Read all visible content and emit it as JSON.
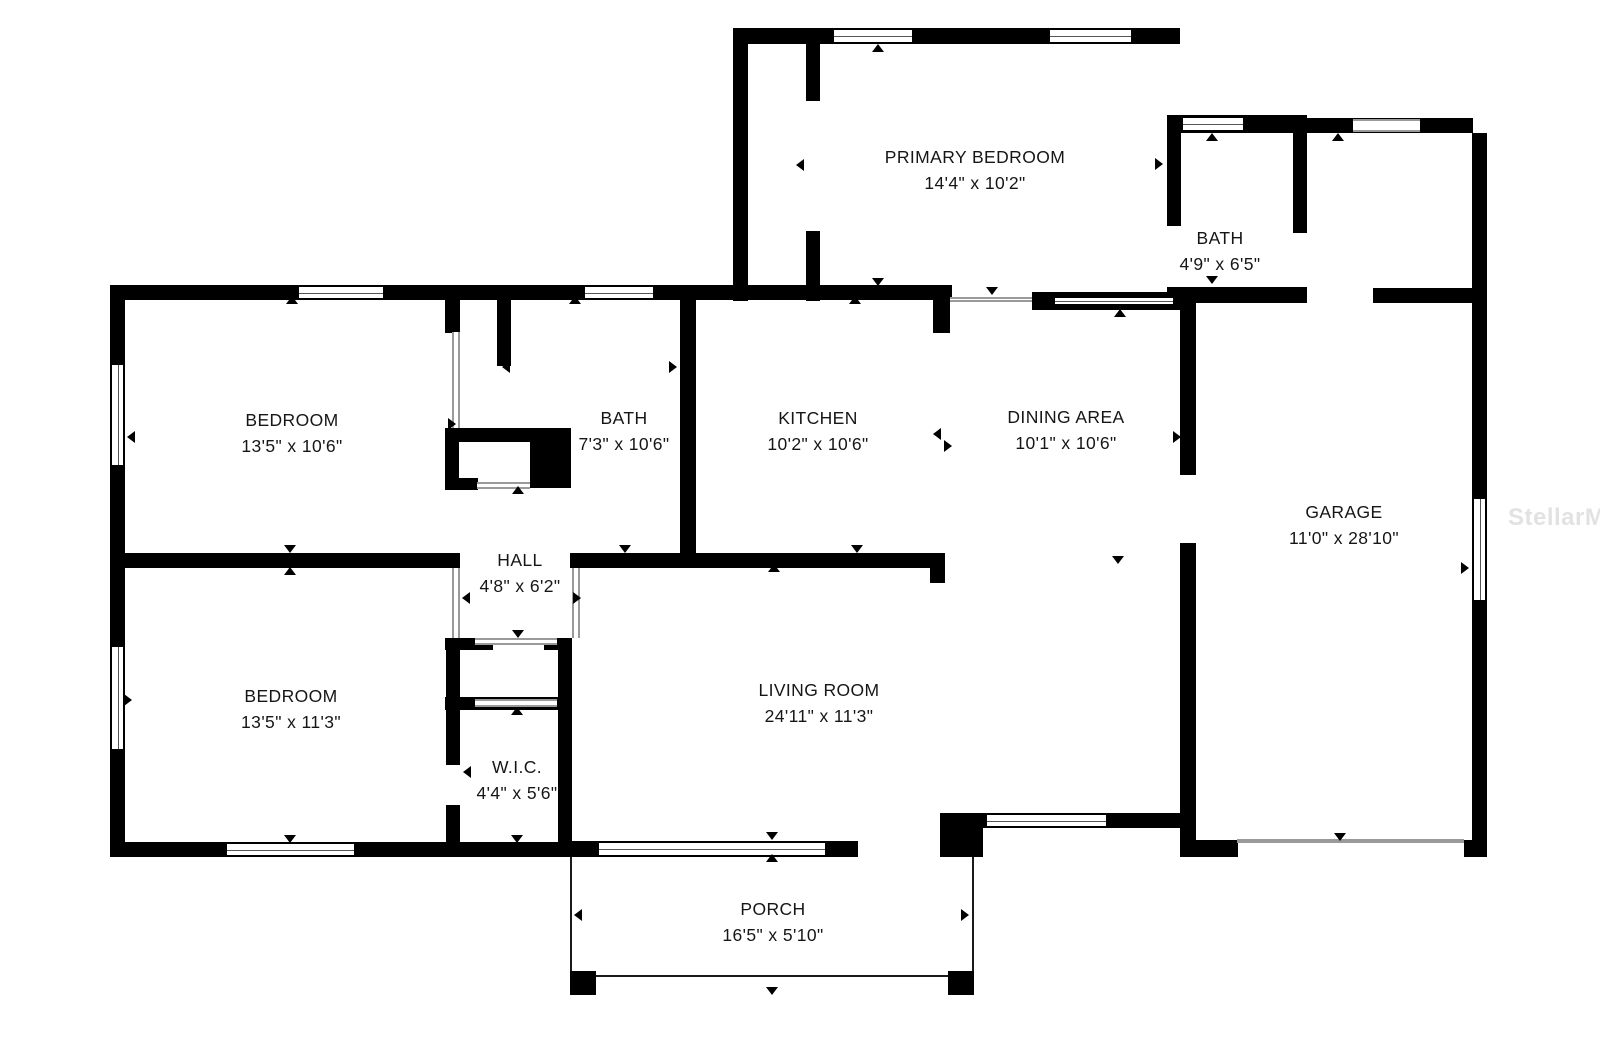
{
  "watermark": "StellarMLS",
  "colors": {
    "wall": "#000000",
    "background": "#ffffff",
    "watermark_gray": "#e2e2e2"
  },
  "rooms": [
    {
      "name": "PRIMARY BEDROOM",
      "dims": "14'4\" x 10'2\""
    },
    {
      "name": "BATH",
      "dims": "4'9\" x 6'5\""
    },
    {
      "name": "BEDROOM",
      "dims": "13'5\" x 10'6\""
    },
    {
      "name": "BATH",
      "dims": "7'3\" x 10'6\""
    },
    {
      "name": "KITCHEN",
      "dims": "10'2\" x 10'6\""
    },
    {
      "name": "DINING AREA",
      "dims": "10'1\" x 10'6\""
    },
    {
      "name": "GARAGE",
      "dims": "11'0\" x 28'10\""
    },
    {
      "name": "HALL",
      "dims": "4'8\" x 6'2\""
    },
    {
      "name": "BEDROOM",
      "dims": "13'5\" x 11'3\""
    },
    {
      "name": "LIVING ROOM",
      "dims": "24'11\" x 11'3\""
    },
    {
      "name": "W.I.C.",
      "dims": "4'4\" x 5'6\""
    },
    {
      "name": "PORCH",
      "dims": "16'5\" x 5'10\""
    }
  ]
}
